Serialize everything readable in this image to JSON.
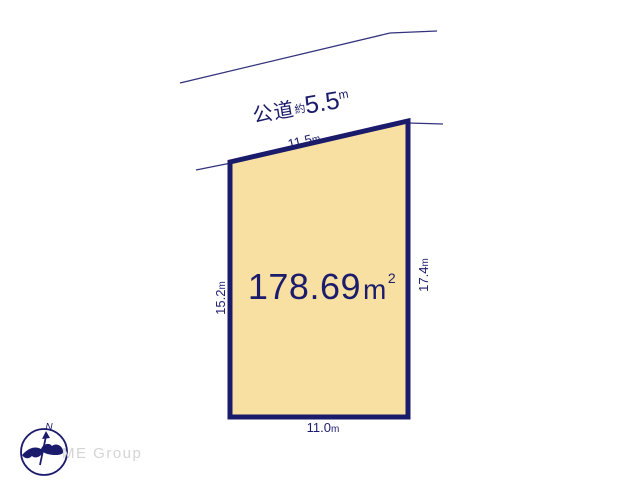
{
  "colors": {
    "line_navy": "#32327e",
    "plot_fill": "#f8dfa2",
    "plot_border": "#1b1b6c",
    "text_navy": "#1c1c6c",
    "logo_gray": "#d4d4d4"
  },
  "road": {
    "name": "公道",
    "approx": "約",
    "width_value": "5.5",
    "unit": "m"
  },
  "plot": {
    "area_value": "178.69",
    "area_unit_base": "m",
    "area_unit_exponent": "2",
    "dimensions": {
      "top": {
        "value": "11.5",
        "unit": "m"
      },
      "left": {
        "value": "15.2",
        "unit": "m"
      },
      "right": {
        "value": "17.4",
        "unit": "m"
      },
      "bottom": {
        "value": "11.0",
        "unit": "m"
      }
    }
  },
  "compass": {
    "north_label": "N"
  },
  "branding": {
    "logo_text": "ME Group"
  }
}
